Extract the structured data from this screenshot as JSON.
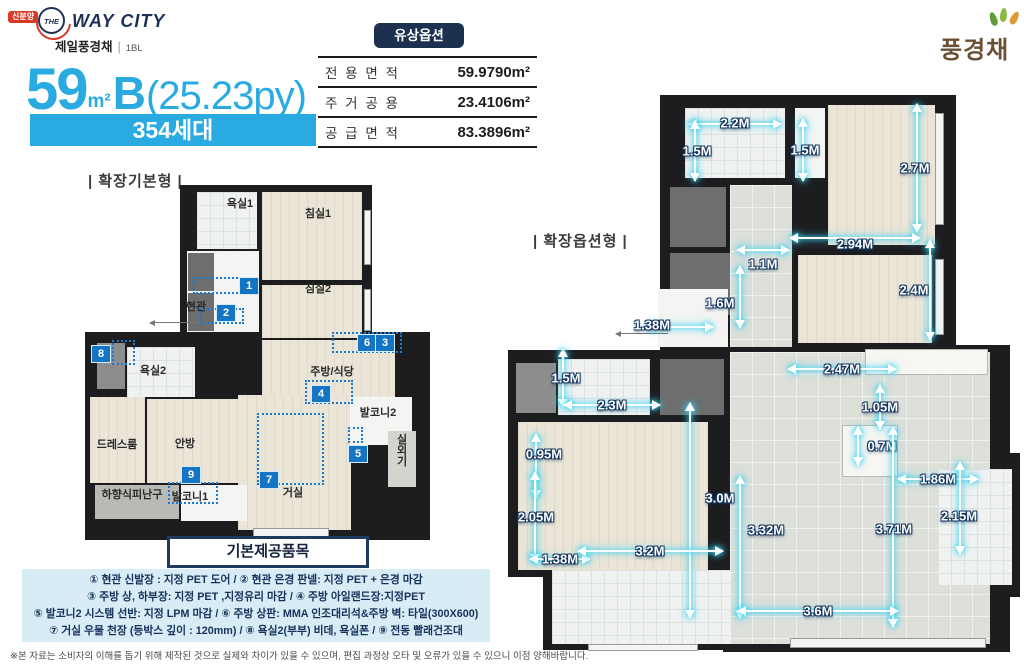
{
  "header": {
    "badge": "신분양",
    "brand_the": "THE",
    "brand": "WAY CITY",
    "subbrand": "제일풍경채",
    "block": "1BL",
    "paid_option": "유상옵션",
    "corp_logo": "풍경채"
  },
  "title": {
    "num": "59",
    "unit": "m²",
    "type": "B",
    "py": "(25.23py)",
    "households": "354세대"
  },
  "area_table": {
    "rows": [
      {
        "label": "전 용 면 적",
        "value": "59.9790m²"
      },
      {
        "label": "주 거 공 용",
        "value": "23.4106m²"
      },
      {
        "label": "공 급 면 적",
        "value": "83.3896m²"
      }
    ]
  },
  "plans": {
    "left": {
      "label": "| 확장기본형 |",
      "rooms": [
        {
          "name": "욕실1",
          "x": 155,
          "y": 18
        },
        {
          "name": "침실1",
          "x": 233,
          "y": 28
        },
        {
          "name": "침실2",
          "x": 233,
          "y": 103
        },
        {
          "name": "현관",
          "x": 111,
          "y": 121
        },
        {
          "name": "욕실2",
          "x": 68,
          "y": 185
        },
        {
          "name": "주방/식당",
          "x": 247,
          "y": 186
        },
        {
          "name": "발코니2",
          "x": 293,
          "y": 227
        },
        {
          "name": "드레스룸",
          "x": 32,
          "y": 259
        },
        {
          "name": "안방",
          "x": 100,
          "y": 258
        },
        {
          "name": "실외기",
          "x": 316,
          "y": 265,
          "rot": true
        },
        {
          "name": "하향식피난구",
          "x": 47,
          "y": 309
        },
        {
          "name": "발코니1",
          "x": 105,
          "y": 311
        },
        {
          "name": "거실",
          "x": 208,
          "y": 307
        }
      ],
      "markers": [
        {
          "n": "1",
          "x": 163,
          "y": 100
        },
        {
          "n": "2",
          "x": 140,
          "y": 127
        },
        {
          "n": "6",
          "x": 281,
          "y": 157
        },
        {
          "n": "3",
          "x": 299,
          "y": 157
        },
        {
          "n": "4",
          "x": 235,
          "y": 208
        },
        {
          "n": "5",
          "x": 272,
          "y": 268
        },
        {
          "n": "7",
          "x": 183,
          "y": 294
        },
        {
          "n": "8",
          "x": 15,
          "y": 168
        },
        {
          "n": "9",
          "x": 105,
          "y": 289
        }
      ],
      "dotted": [
        {
          "x": 108,
          "y": 92,
          "w": 52,
          "h": 17
        },
        {
          "x": 115,
          "y": 123,
          "w": 44,
          "h": 16
        },
        {
          "x": 247,
          "y": 147,
          "w": 70,
          "h": 21
        },
        {
          "x": 220,
          "y": 195,
          "w": 48,
          "h": 24
        },
        {
          "x": 263,
          "y": 242,
          "w": 15,
          "h": 16
        },
        {
          "x": 172,
          "y": 228,
          "w": 67,
          "h": 72
        },
        {
          "x": 27,
          "y": 155,
          "w": 23,
          "h": 25
        },
        {
          "x": 83,
          "y": 297,
          "w": 50,
          "h": 22
        }
      ]
    },
    "right": {
      "label": "| 확장옵션형 |",
      "dims": [
        {
          "v": "2.2M",
          "o": "h",
          "x": 227,
          "y": 29,
          "len": 92,
          "lx": 0,
          "ly": -1
        },
        {
          "v": "1.5M",
          "o": "v",
          "x": 187,
          "y": 56,
          "len": 60,
          "lx": 2,
          "ly": 0
        },
        {
          "v": "1.5M",
          "o": "v",
          "x": 295,
          "y": 55,
          "len": 62,
          "lx": 2,
          "ly": 0
        },
        {
          "v": "2.7M",
          "o": "v",
          "x": 409,
          "y": 73,
          "len": 128,
          "lx": -2,
          "ly": 0
        },
        {
          "v": "2.94M",
          "o": "h",
          "x": 347,
          "y": 143,
          "len": 130,
          "lx": 0,
          "ly": 6
        },
        {
          "v": "1.1M",
          "o": "h",
          "x": 255,
          "y": 155,
          "len": 52,
          "lx": 0,
          "ly": 14
        },
        {
          "v": "2.4M",
          "o": "v",
          "x": 422,
          "y": 195,
          "len": 100,
          "lx": -16,
          "ly": 0
        },
        {
          "v": "1.6M",
          "o": "v",
          "x": 232,
          "y": 202,
          "len": 62,
          "lx": -20,
          "ly": 6
        },
        {
          "v": "1.38M",
          "o": "h",
          "x": 172,
          "y": 232,
          "len": 66,
          "lx": -28,
          "ly": -2
        },
        {
          "v": "2.47M",
          "o": "h",
          "x": 334,
          "y": 274,
          "len": 108,
          "lx": 0,
          "ly": 0
        },
        {
          "v": "1.5M",
          "o": "v",
          "x": 55,
          "y": 283,
          "len": 58,
          "lx": 3,
          "ly": 0
        },
        {
          "v": "2.3M",
          "o": "h",
          "x": 104,
          "y": 310,
          "len": 96,
          "lx": 0,
          "ly": 0
        },
        {
          "v": "1.05M",
          "o": "v",
          "x": 372,
          "y": 312,
          "len": 44,
          "lx": 0,
          "ly": 0
        },
        {
          "v": "0.7M",
          "o": "v",
          "x": 350,
          "y": 351,
          "len": 38,
          "lx": 24,
          "ly": 0
        },
        {
          "v": "0.95M",
          "o": "v",
          "x": 28,
          "y": 371,
          "len": 64,
          "lx": 8,
          "ly": -12
        },
        {
          "v": "1.86M",
          "o": "h",
          "x": 430,
          "y": 384,
          "len": 80,
          "lx": 0,
          "ly": 0
        },
        {
          "v": "3.0M",
          "o": "v",
          "x": 182,
          "y": 415,
          "len": 215,
          "lx": 30,
          "ly": -12
        },
        {
          "v": "2.05M",
          "o": "v",
          "x": 27,
          "y": 422,
          "len": 90,
          "lx": 1,
          "ly": 0
        },
        {
          "v": "3.32M",
          "o": "v",
          "x": 232,
          "y": 452,
          "len": 142,
          "lx": 26,
          "ly": -17
        },
        {
          "v": "3.71M",
          "o": "v",
          "x": 385,
          "y": 432,
          "len": 200,
          "lx": 1,
          "ly": 2
        },
        {
          "v": "2.15M",
          "o": "v",
          "x": 452,
          "y": 413,
          "len": 92,
          "lx": -1,
          "ly": 8
        },
        {
          "v": "1.38M",
          "o": "h",
          "x": 52,
          "y": 464,
          "len": 60,
          "lx": 0,
          "ly": 0
        },
        {
          "v": "3.2M",
          "o": "h",
          "x": 142,
          "y": 456,
          "len": 145,
          "lx": 0,
          "ly": 0
        },
        {
          "v": "3.6M",
          "o": "h",
          "x": 310,
          "y": 516,
          "len": 160,
          "lx": 0,
          "ly": 0
        }
      ]
    }
  },
  "items_box": {
    "title": "기본제공품목",
    "lines": [
      "① 현관 신발장 : 지정 PET 도어 / ② 현관 은경 판넬: 지정 PET + 은경 마감",
      "③ 주방 상, 하부장: 지정 PET ,지정유리 마감 / ④ 주방 아일랜드장:지정PET",
      "⑤ 발코니2 시스템 선반: 지정 LPM 마감  / ⑥ 주방 상판: MMA 인조대리석&주방 벽: 타일(300X600)",
      "⑦ 거실 우물 천장 (등박스 깊이 : 120mm) / ⑧ 욕실2(부부) 비데, 욕실폰  / ⑨ 전동 빨래건조대"
    ]
  },
  "footer": "※본 자료는 소비자의 이해를 돕기 위해 제작된 것으로 실제와 차이가 있을 수 있으며, 편집 과정상 오타 및 오류가 있을 수 있으니 이점 양해바랍니다.",
  "colors": {
    "accent": "#29abe2",
    "navy": "#1c3050",
    "dim_glow": "#35d2f2",
    "marker_blue": "#1575c5",
    "list_bg": "#d7ecf5",
    "badge_red": "#d93a26",
    "corp_brown": "#6b4f33"
  }
}
